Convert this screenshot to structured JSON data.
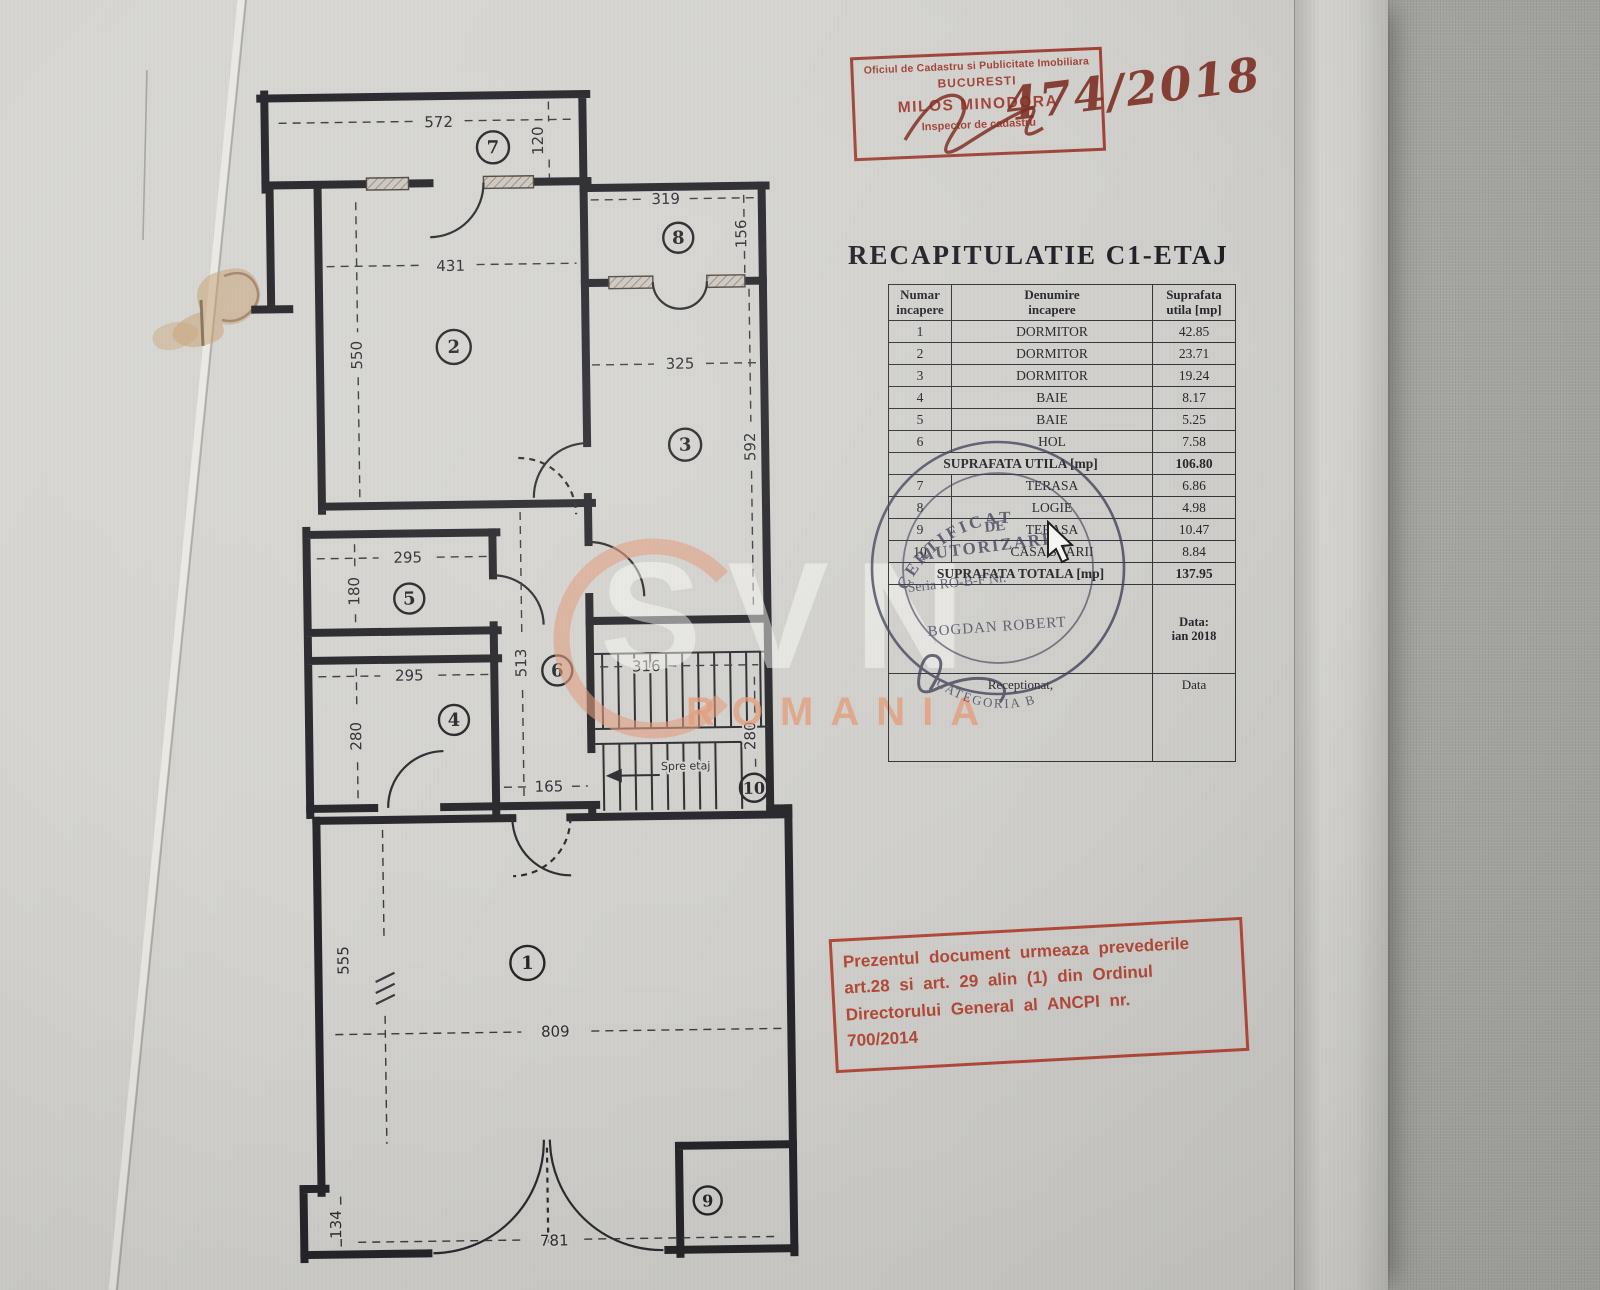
{
  "document": {
    "title": "RECAPITULATIE C1-ETAJ"
  },
  "recap": {
    "headers": {
      "c1l1": "Numar",
      "c1l2": "incapere",
      "c2l1": "Denumire",
      "c2l2": "incapere",
      "c3l1": "Suprafata",
      "c3l2": "utila [mp]"
    },
    "rows": [
      {
        "nr": "1",
        "name": "DORMITOR",
        "area": "42.85"
      },
      {
        "nr": "2",
        "name": "DORMITOR",
        "area": "23.71"
      },
      {
        "nr": "3",
        "name": "DORMITOR",
        "area": "19.24"
      },
      {
        "nr": "4",
        "name": "BAIE",
        "area": "8.17"
      },
      {
        "nr": "5",
        "name": "BAIE",
        "area": "5.25"
      },
      {
        "nr": "6",
        "name": "HOL",
        "area": "7.58"
      }
    ],
    "subtotal": {
      "label": "SUPRAFATA UTILA [mp]",
      "value": "106.80"
    },
    "rows2": [
      {
        "nr": "7",
        "name": "TERASA",
        "area": "6.86"
      },
      {
        "nr": "8",
        "name": "LOGIE",
        "area": "4.98"
      },
      {
        "nr": "9",
        "name": "TERASA",
        "area": "10.47"
      },
      {
        "nr": "10",
        "name": "CASA SCARII",
        "area": "8.84"
      }
    ],
    "total": {
      "label": "SUPRAFATA TOTALA [mp]",
      "value": "137.95"
    },
    "date_row": {
      "l1": "Data:",
      "l2": "ian 2018"
    },
    "footer_row": {
      "left": "Receptionat,",
      "right": "Data"
    }
  },
  "stamps": {
    "ocpi": {
      "line1": "Oficiul de Cadastru si Publicitate Imobiliara",
      "line2": "BUCURESTI",
      "line3": "MILOS MINODORA",
      "line4": "Inspector de cadastru"
    },
    "handwritten_number": "474/2018",
    "legal": {
      "line1": "Prezentul document urmeaza prevederile",
      "line2": "art.28 si art. 29 alin (1) din Ordinul",
      "line3": "Directorului General al ANCPI nr.",
      "line4": "700/2014"
    },
    "round": {
      "arc_top": "CERTIFICAT",
      "word_de": "DE",
      "word_aut": "AUTORIZARE",
      "seria": "Seria RO-B-F Nr.",
      "name": "BOGDAN ROBERT",
      "arc_bottom": "CATEGORIA B"
    }
  },
  "watermark": {
    "brand": "SVN",
    "country": "ROMANIA"
  },
  "plan": {
    "rooms": {
      "r1": "1",
      "r2": "2",
      "r3": "3",
      "r4": "4",
      "r5": "5",
      "r6": "6",
      "r7": "7",
      "r8": "8",
      "r9": "9",
      "r10": "10"
    },
    "dims": {
      "terrace_w": "572",
      "terrace_h": "120",
      "room2_w": "431",
      "room2_h": "550",
      "room8_w": "319",
      "room8_h": "156",
      "room3_w": "325",
      "room3_h": "592",
      "room5_w": "295",
      "room5_h": "180",
      "room4_w": "295",
      "room4_h": "280",
      "hall_h": "513",
      "hall_w": "165",
      "stairs_w": "316",
      "stairs_h": "280",
      "room1_h": "555",
      "room1_w": "809",
      "alcove_h": "134",
      "bottom_w": "781"
    },
    "stair_note": "Spre etaj"
  },
  "colors": {
    "paper": "#d3d2ce",
    "fabric": "#a9a9a5",
    "ink": "#26262a",
    "stamp_red_top": "#9c372b",
    "stamp_red_bottom": "#b0402f",
    "handwriting": "#7c2b1f",
    "round_stamp": "#3c3d55",
    "watermark_orange": "#e39874"
  }
}
